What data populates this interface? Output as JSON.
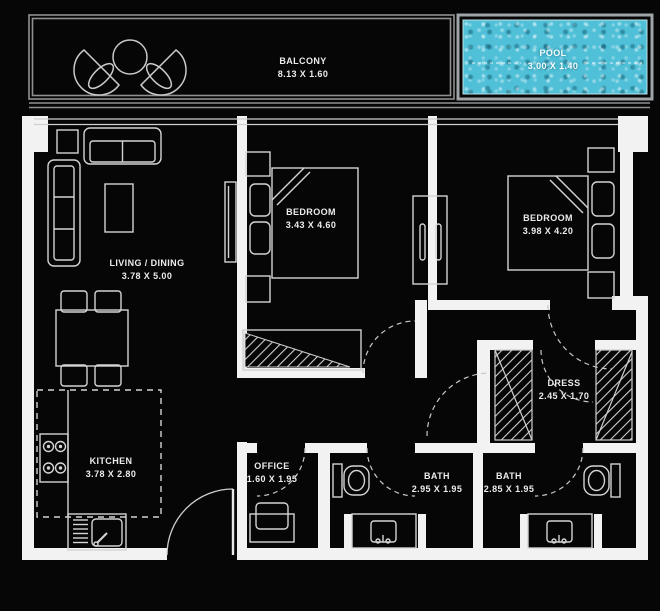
{
  "plan": {
    "type": "apartment-floor-plan",
    "colors": {
      "background": "#060606",
      "wall": "#f2f2f2",
      "line": "#d4d4d4",
      "text": "#ececec",
      "pool_water": "#4fc0d8",
      "pool_border": "#9fa4a6",
      "balcony_line": "#8f9092"
    },
    "rooms": [
      {
        "id": "balcony",
        "name": "BALCONY",
        "dims": "8.13 X 1.60"
      },
      {
        "id": "pool",
        "name": "POOL",
        "dims": "3.00 X 1.40"
      },
      {
        "id": "living",
        "name": "LIVING / DINING",
        "dims": "3.78 X 5.00"
      },
      {
        "id": "bedroom1",
        "name": "BEDROOM",
        "dims": "3.43 X 4.60"
      },
      {
        "id": "bedroom2",
        "name": "BEDROOM",
        "dims": "3.98 X 4.20"
      },
      {
        "id": "kitchen",
        "name": "KITCHEN",
        "dims": "3.78 X 2.80"
      },
      {
        "id": "office",
        "name": "OFFICE",
        "dims": "1.60 X 1.95"
      },
      {
        "id": "bath1",
        "name": "BATH",
        "dims": "2.95 X 1.95"
      },
      {
        "id": "bath2",
        "name": "BATH",
        "dims": "2.85 X 1.95"
      },
      {
        "id": "dress",
        "name": "DRESS",
        "dims": "2.45 X 1.70"
      }
    ],
    "icons": [
      "lounge-chair-icon",
      "round-table-icon",
      "pool-icon",
      "sofa-icon",
      "side-table-icon",
      "coffee-table-icon",
      "tv-icon",
      "dining-table-icon",
      "chair-icon",
      "stove-icon",
      "kitchen-sink-icon",
      "entrance-door-icon",
      "bed-icon",
      "pillow-icon",
      "nightstand-icon",
      "wardrobe-icon",
      "hatched-closet-icon",
      "desk-icon",
      "toilet-icon",
      "washbasin-icon",
      "door-swing-icon"
    ]
  }
}
